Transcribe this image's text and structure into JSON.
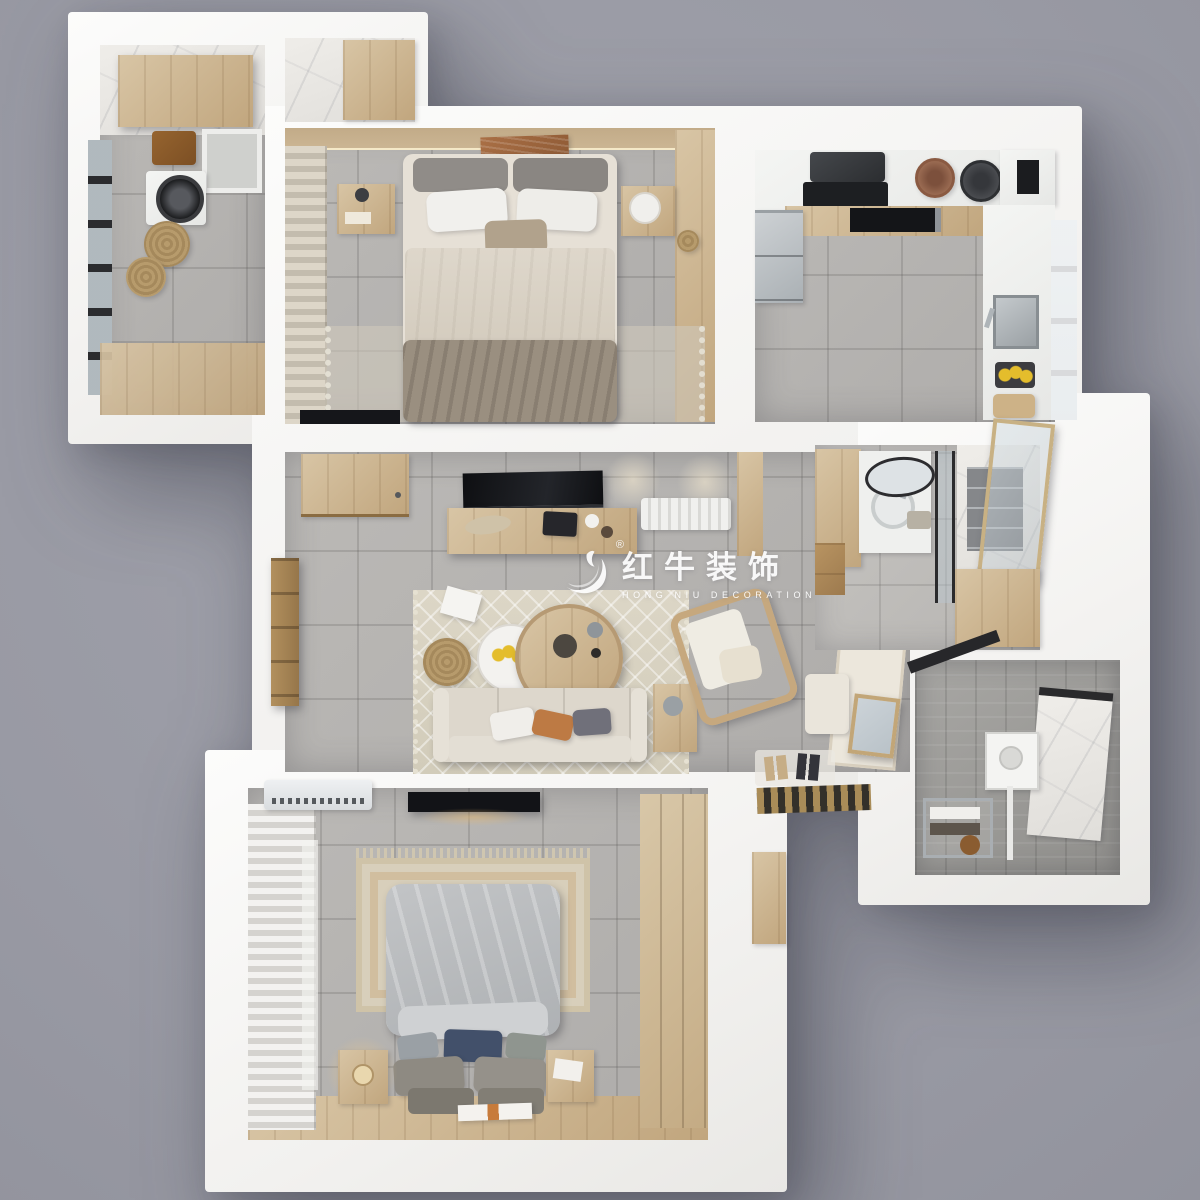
{
  "watermark": {
    "brand_cn": "红牛装饰",
    "brand_en": "HONG NIU DECORATION",
    "registered_mark": "®",
    "logo": "bull-swoosh-icon",
    "color": "#ffffff"
  },
  "palette": {
    "background": "#999aa4",
    "wall": "#f4f3f1",
    "floor_tile": "#b6b4b1",
    "floor_marble": "#eae8e4",
    "wood": "#cdb392",
    "wood_dark": "#a8885f",
    "fabric_cream": "#ddd7cc",
    "fabric_taupe": "#9a8f80",
    "duvet_gray": "#b9bcbe",
    "pillow_navy": "#42506a",
    "accent_orange": "#bd7a44",
    "lemon_yellow": "#e4bd2c",
    "tv_black": "#121317",
    "steel": "#b8bcc0"
  },
  "scene": {
    "type": "3d-floorplan-top-view",
    "rooms": [
      {
        "name": "laundry-balcony",
        "furniture": [
          "wall-cabinet",
          "laundry-sink",
          "washing-machine",
          "storage-box",
          "rattan-baskets",
          "black-frame-window",
          "wood-sill"
        ]
      },
      {
        "name": "closet-nook",
        "furniture": [
          "wardrobe"
        ]
      },
      {
        "name": "bedroom-2",
        "furniture": [
          "double-bed",
          "white-pillows",
          "nightstand-left",
          "nightstand-right",
          "wall-art",
          "wardrobe",
          "knit-curtain",
          "rug",
          "tv"
        ]
      },
      {
        "name": "kitchen",
        "furniture": [
          "range-hood",
          "cooktop",
          "induction-hob",
          "cookware-pots",
          "coffee-machine",
          "refrigerator",
          "sink",
          "lemon-basket",
          "cutting-board",
          "window",
          "counters"
        ]
      },
      {
        "name": "living-room",
        "furniture": [
          "tv",
          "tv-console",
          "radiator",
          "area-rug",
          "coffee-table",
          "side-table-white",
          "jute-pouf",
          "sofa",
          "throw-pillows",
          "rattan-armchair",
          "vase-side-table",
          "entry-door",
          "bedroom-door",
          "bench",
          "leaning-mirror",
          "leaning-panel",
          "slippers-mat",
          "doormat"
        ]
      },
      {
        "name": "bathroom",
        "furniture": [
          "wood-vanity",
          "counter-sink",
          "oval-led-mirror",
          "glass-shower-partition",
          "marble-shower-niche",
          "gold-framed-glass-panel",
          "storage-cabinet"
        ]
      },
      {
        "name": "shower-room",
        "furniture": [
          "rain-shower-panel",
          "marble-window-panel",
          "towel-rack"
        ]
      },
      {
        "name": "master-bedroom",
        "furniture": [
          "double-bed",
          "gray-duvet",
          "navy-pillow",
          "bench-cushions",
          "nightstand-with-lamp",
          "nightstand-right",
          "area-rug",
          "wavy-curtains",
          "air-conditioner",
          "tv",
          "wardrobe",
          "floor-magazine",
          "wood-floor-strip"
        ]
      }
    ]
  }
}
